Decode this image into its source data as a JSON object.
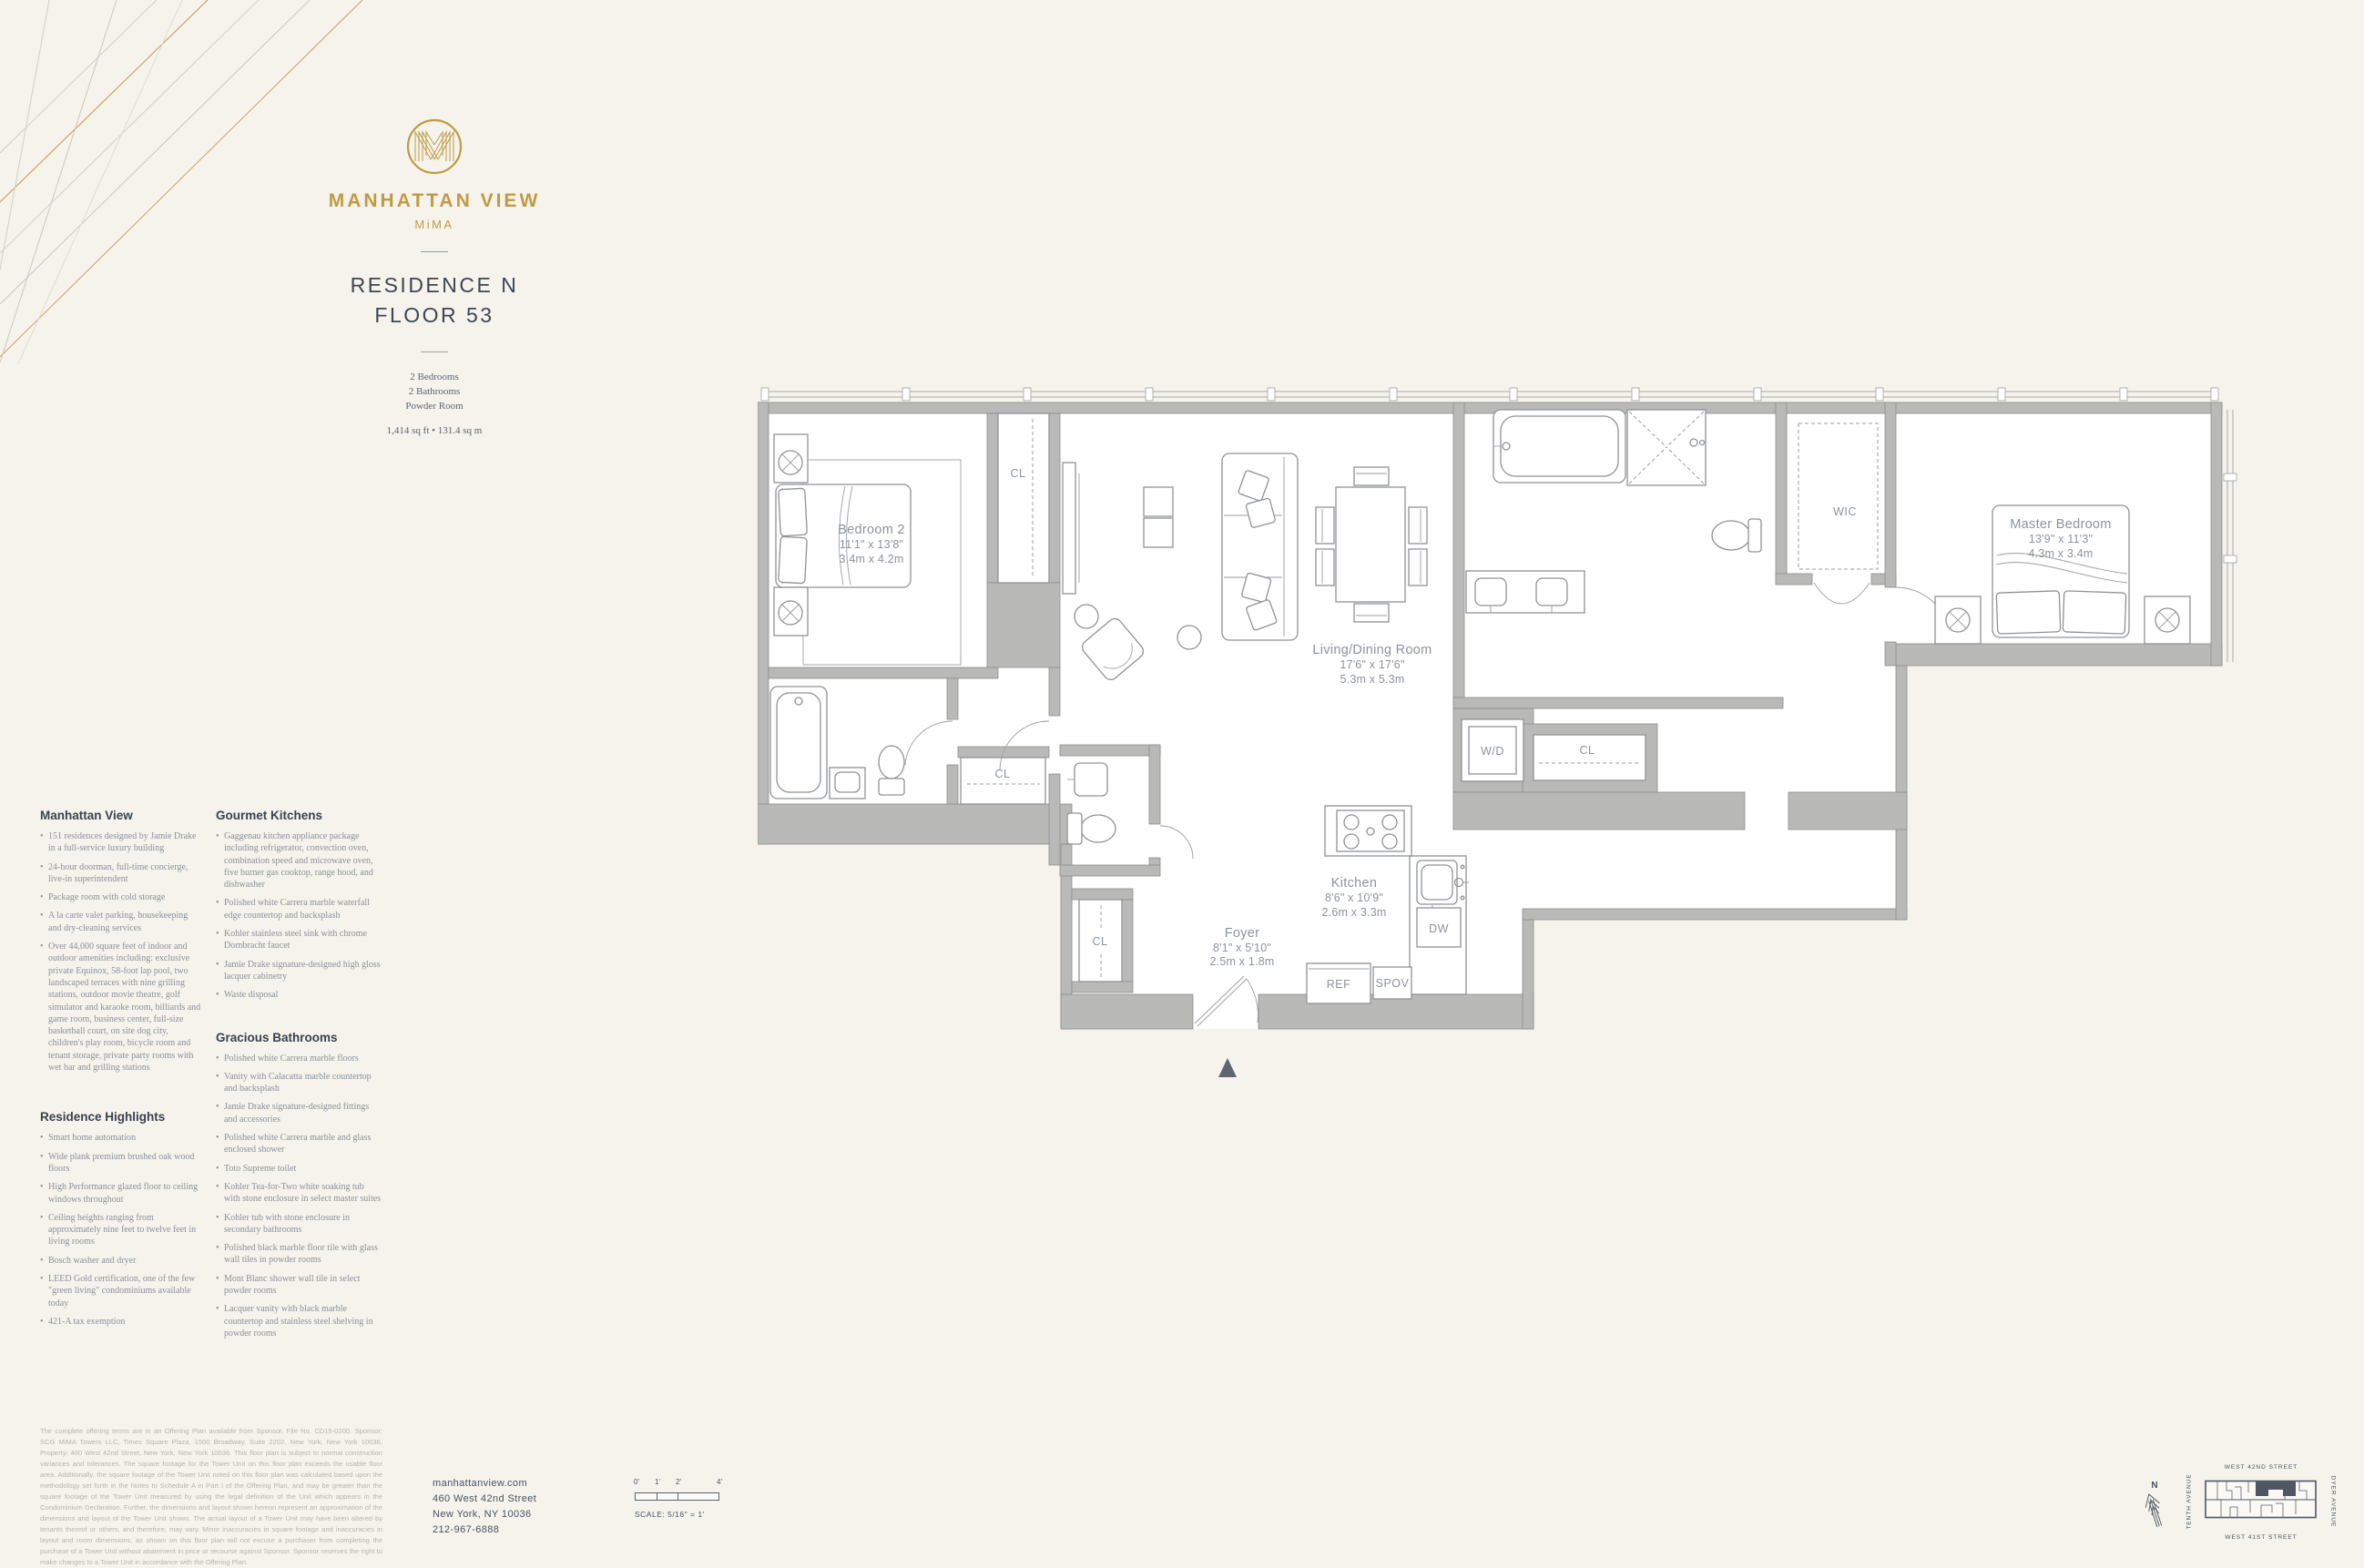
{
  "brand": {
    "name": "MANHATTAN VIEW",
    "sub": "MiMA",
    "logo_letter": "M"
  },
  "header": {
    "residence": "RESIDENCE N",
    "floor": "FLOOR 53",
    "features": [
      "2 Bedrooms",
      "2 Bathrooms",
      "Powder Room"
    ],
    "area": "1,414 sq ft • 131.4 sq m"
  },
  "sections": {
    "manhattan_view": {
      "title": "Manhattan View",
      "bullets": [
        "151 residences designed by Jamie Drake in a full-service luxury building",
        "24-hour doorman, full-time concierge, live-in superintendent",
        "Package room with cold storage",
        "A la carte valet parking, housekeeping and dry-cleaning services",
        "Over 44,000 square feet of indoor and outdoor amenities including: exclusive private Equinox, 58-foot lap pool, two landscaped terraces with nine grilling stations, outdoor movie theatre, golf simulator and karaoke room, billiards and game room, business center, full-size basketball court, on site dog city, children's play room, bicycle room and tenant storage, private party rooms with wet bar and grilling stations"
      ]
    },
    "residence_highlights": {
      "title": "Residence Highlights",
      "bullets": [
        "Smart home automation",
        "Wide plank premium brushed oak wood floors",
        "High Performance glazed floor to ceiling windows throughout",
        "Ceiling heights ranging from approximately nine feet to twelve feet in living rooms",
        "Bosch washer and dryer",
        "LEED Gold certification, one of the few \"green living\" condominiums available today",
        "421-A tax exemption"
      ]
    },
    "gourmet_kitchens": {
      "title": "Gourmet Kitchens",
      "bullets": [
        "Gaggenau kitchen appliance package including refrigerator, convection oven, combination speed and microwave oven, five burner gas cooktop, range hood, and dishwasher",
        "Polished white Carrera marble waterfall edge countertop and backsplash",
        "Kohler stainless steel sink with chrome Dornbracht faucet",
        "Jamie Drake signature-designed high gloss lacquer cabinetry",
        "Waste disposal"
      ]
    },
    "gracious_bathrooms": {
      "title": "Gracious Bathrooms",
      "bullets": [
        "Polished white Carrera marble floors",
        "Vanity with Calacatta marble countertop and backsplash",
        "Jamie Drake signature-designed fittings and accessories",
        "Polished white Carrera marble and glass enclosed shower",
        "Toto Supreme toilet",
        "Kohler Tea-for-Two white soaking tub with stone enclosure in select master suites",
        "Kohler tub with stone enclosure in secondary bathrooms",
        "Polished black marble floor tile with glass wall tiles in powder rooms",
        "Mont Blanc shower wall tile in select powder rooms",
        "Lacquer vanity with black marble countertop and stainless steel shelving in powder rooms"
      ]
    }
  },
  "floorplan": {
    "rooms": {
      "bedroom2": {
        "name": "Bedroom 2",
        "dims_ft": "11'1\" x 13'8\"",
        "dims_m": "3.4m x 4.2m"
      },
      "living": {
        "name": "Living/Dining Room",
        "dims_ft": "17'6\" x 17'6\"",
        "dims_m": "5.3m x 5.3m"
      },
      "master": {
        "name": "Master Bedroom",
        "dims_ft": "13'9\" x 11'3\"",
        "dims_m": "4.3m x 3.4m"
      },
      "kitchen": {
        "name": "Kitchen",
        "dims_ft": "8'6\" x 10'9\"",
        "dims_m": "2.6m x 3.3m"
      },
      "foyer": {
        "name": "Foyer",
        "dims_ft": "8'1\" x 5'10\"",
        "dims_m": "2.5m x 1.8m"
      }
    },
    "labels": {
      "wic": "WIC",
      "wd": "W/D",
      "cl": "CL",
      "ref": "REF",
      "spov": "SPOV",
      "dw": "DW"
    }
  },
  "footer": {
    "disclaimer": "The complete offering terms are in an Offering Plan available from Sponsor, File No. CD15-0200. Sponsor: SCG MiMA Towers LLC, Times Square Plaza, 1500 Broadway, Suite 2202, New York, New York 10036. Property: 460 West 42nd Street, New York, New York 10036. This floor plan is subject to normal construction variances and tolerances. The square footage for the Tower Unit on this floor plan exceeds the usable floor area. Additionally, the square footage of the Tower Unit noted on this floor plan was calculated based upon the methodology set forth in the Notes to Schedule A in Part I of the Offering Plan, and may be greater than the square footage of the Tower Unit measured by using the legal definition of the Unit which appears in the Condominium Declaration. Further, the dimensions and layout shown hereon represent an approximation of the dimensions and layout of the Tower Unit shown. The actual layout of a Tower Unit may have been altered by tenants thereof or others, and therefore, may vary. Minor inaccuracies in square footage and inaccuracies in layout and room dimensions, as shown on this floor plan will not excuse a purchaser from completing the purchase of a Tower Unit without abatement in price or recourse against Sponsor. Sponsor reserves the right to make changes to a Tower Unit in accordance with the Offering Plan.",
    "contact": {
      "website": "manhattanview.com",
      "address1": "460 West 42nd Street",
      "address2": "New York, NY 10036",
      "phone": "212-967-6888"
    },
    "scale": {
      "ticks": [
        "0'",
        "1'",
        "2'",
        "4'"
      ],
      "label": "SCALE: 5/16\" = 1'"
    },
    "map": {
      "north": "N",
      "streets": {
        "top": "WEST 42ND STREET",
        "bottom": "WEST 41ST STREET",
        "left": "TENTH AVENUE",
        "right": "DYER AVENUE"
      }
    }
  }
}
